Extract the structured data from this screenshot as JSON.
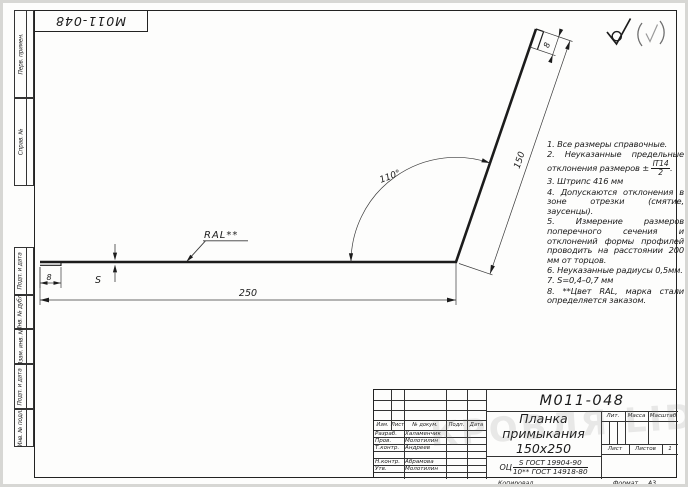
{
  "stamp": {
    "doc_number_rotated": "М011-048"
  },
  "dims": {
    "length": "250",
    "leg": "150",
    "angle": "110°",
    "hem_left": "8",
    "hem_top": "8",
    "thickness": "S",
    "coating_label": "RAL**"
  },
  "surface_roughness": {
    "main_symbol": "check-with-circle",
    "other_symbol": "(check)"
  },
  "notes": [
    {
      "text": "1. Все размеры справочные."
    },
    {
      "text": "2. Неуказанные предельные отклонения размеров ±",
      "frac_top": "IT14",
      "frac_bottom": "2",
      "tail": "."
    },
    {
      "text": "3. Штрипс 416 мм"
    },
    {
      "text": "4. Допускаются отклонения в зоне отрезки (смятие, заусенцы)."
    },
    {
      "text": "5. Измерение размеров поперечного сечения и отклонений формы профилей проводить на расстоянии 200 мм от торцов."
    },
    {
      "text": "6. Неуказанные радиусы 0,5мм."
    },
    {
      "text": "7. S=0,4–0,7 мм"
    },
    {
      "text": "8. **Цвет RAL, марка стали определяется заказом."
    }
  ],
  "margin_labels": [
    "Перв. примен.",
    "Справ. №",
    "Подп. и дата",
    "Инв. № дубл.",
    "Взам. инв. №",
    "Подп. и дата",
    "Инв. № подл."
  ],
  "title_block": {
    "doc_number": "М011-048",
    "title_line1": "Планка примыкания",
    "title_line2": "150x250",
    "material": {
      "prefix": "ОЦ",
      "top": "S ГОСТ 19904-90",
      "bottom": "10** ГОСТ 14918-80"
    },
    "header_cols": [
      "Изм.",
      "Лист",
      "№ докум.",
      "Подп.",
      "Дата"
    ],
    "sign_rows": [
      {
        "role": "Разраб.",
        "name": "Халаменчик"
      },
      {
        "role": "Пров.",
        "name": "Молотилин"
      },
      {
        "role": "Т.контр.",
        "name": "Андреев"
      },
      {
        "role": "",
        "name": ""
      },
      {
        "role": "Н.контр.",
        "name": "Абрамова"
      },
      {
        "role": "Утв.",
        "name": "Молотилин"
      }
    ],
    "lit_label": "Лит.",
    "massa_label": "Масса",
    "masshtab_label": "Масштаб",
    "list_label": "Лист",
    "listov_label": "Листов",
    "listov_value": "1",
    "kopiroval": "Копировал",
    "format_label": "Формат",
    "format_value": "А3"
  },
  "watermark": "КРОВЛЯ LID"
}
